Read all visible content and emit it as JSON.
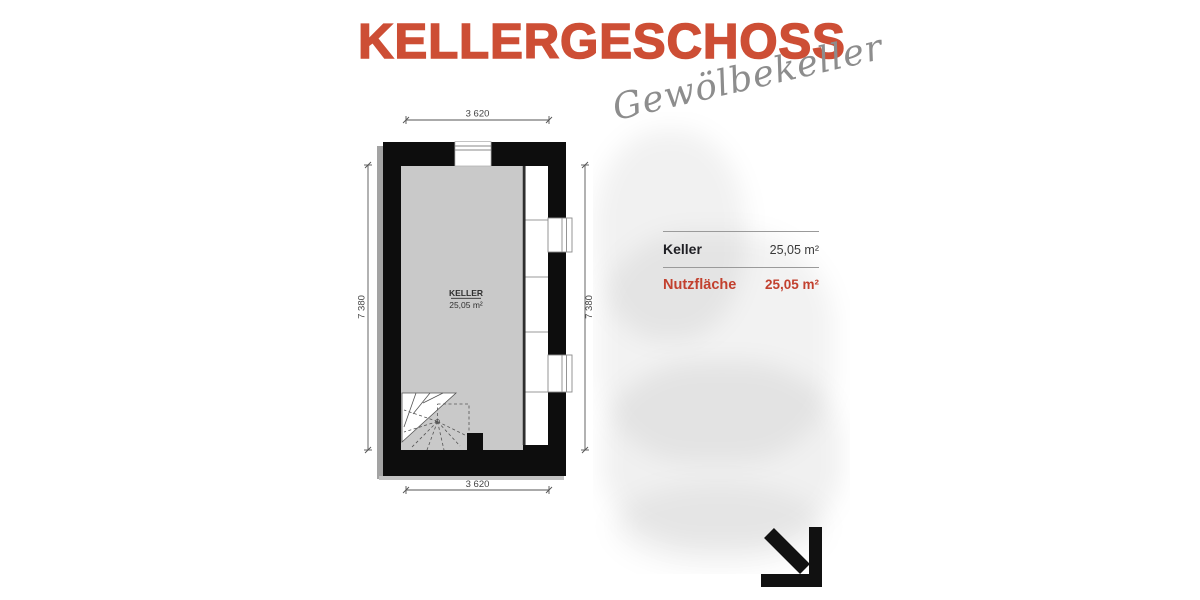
{
  "page": {
    "title": "KELLERGESCHOSS",
    "annotation": "Gewölbekeller"
  },
  "floorplan": {
    "room": {
      "name": "KELLER",
      "area": "25,05 m²"
    },
    "dimensions": {
      "top": "3 620",
      "bottom": "3 620",
      "left": "7 380",
      "right": "7 380"
    }
  },
  "summary_table": {
    "rows": [
      {
        "label": "Keller",
        "value": "25,05 m²"
      },
      {
        "label": "Nutzfläche",
        "value": "25,05 m²"
      }
    ]
  },
  "icons": {
    "direction_arrow": "arrow-down-right"
  },
  "colors": {
    "accent_red": "#cd4e35",
    "table_red": "#c2402e",
    "handwriting_gray": "#8d8d8d",
    "room_fill": "#c9c9c9",
    "wall_black": "#0d0d0d"
  }
}
